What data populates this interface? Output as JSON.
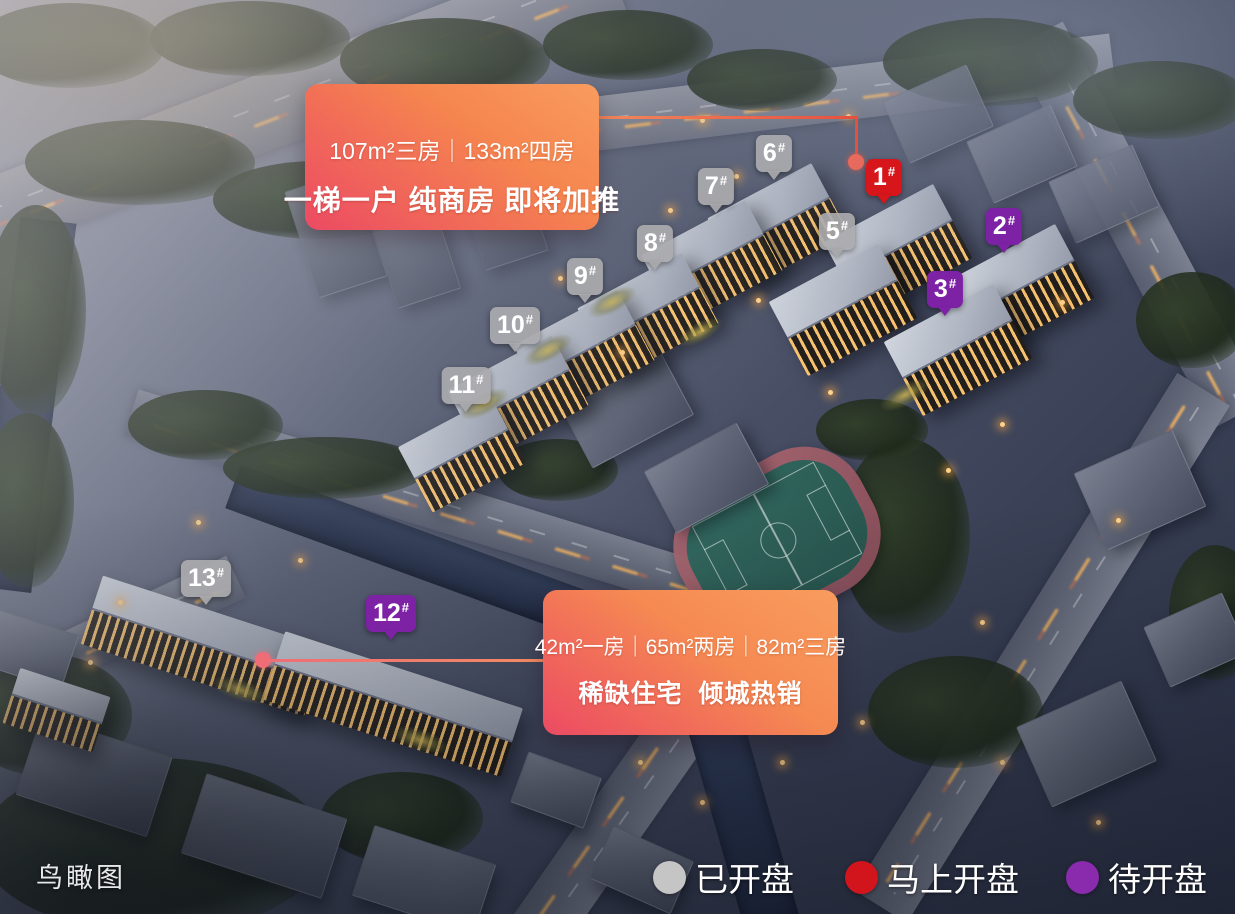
{
  "title": "鸟瞰图",
  "callouts": [
    {
      "line1": "107m²三房｜133m²四房",
      "line2": "一梯一户 纯商房 即将加推"
    },
    {
      "line1": "42m²一房｜65m²两房｜82m²三房",
      "line2": "稀缺住宅  倾城热销"
    }
  ],
  "markers": [
    {
      "num": "1",
      "hash": "#",
      "status": "opening-soon",
      "x": 884,
      "y": 204
    },
    {
      "num": "2",
      "hash": "#",
      "status": "pending",
      "x": 1004,
      "y": 253
    },
    {
      "num": "3",
      "hash": "#",
      "status": "pending",
      "x": 945,
      "y": 316
    },
    {
      "num": "5",
      "hash": "#",
      "status": "on-sale",
      "x": 837,
      "y": 258
    },
    {
      "num": "6",
      "hash": "#",
      "status": "on-sale",
      "x": 774,
      "y": 180
    },
    {
      "num": "7",
      "hash": "#",
      "status": "on-sale",
      "x": 716,
      "y": 213
    },
    {
      "num": "8",
      "hash": "#",
      "status": "on-sale",
      "x": 655,
      "y": 270
    },
    {
      "num": "9",
      "hash": "#",
      "status": "on-sale",
      "x": 585,
      "y": 303
    },
    {
      "num": "10",
      "hash": "#",
      "status": "on-sale",
      "x": 515,
      "y": 352
    },
    {
      "num": "11",
      "hash": "#",
      "status": "on-sale",
      "x": 466,
      "y": 412
    },
    {
      "num": "12",
      "hash": "#",
      "status": "pending",
      "x": 391,
      "y": 640
    },
    {
      "num": "13",
      "hash": "#",
      "status": "on-sale",
      "x": 206,
      "y": 605
    }
  ],
  "status_colors": {
    "on-sale": "rgba(170,170,174,0.92)",
    "opening-soon": "#d6161b",
    "pending": "#7d22a5"
  },
  "legend": [
    {
      "label": "已开盘",
      "color": "#c6c5c6"
    },
    {
      "label": "马上开盘",
      "color": "#d2151d"
    },
    {
      "label": "待开盘",
      "color": "#8a2bad"
    }
  ],
  "colors": {
    "callout_gradient_start": "#ec4a63",
    "callout_gradient_end": "#f99c5e",
    "connector_top": "#e6503e",
    "connector_bottom": "#ee6d76"
  }
}
